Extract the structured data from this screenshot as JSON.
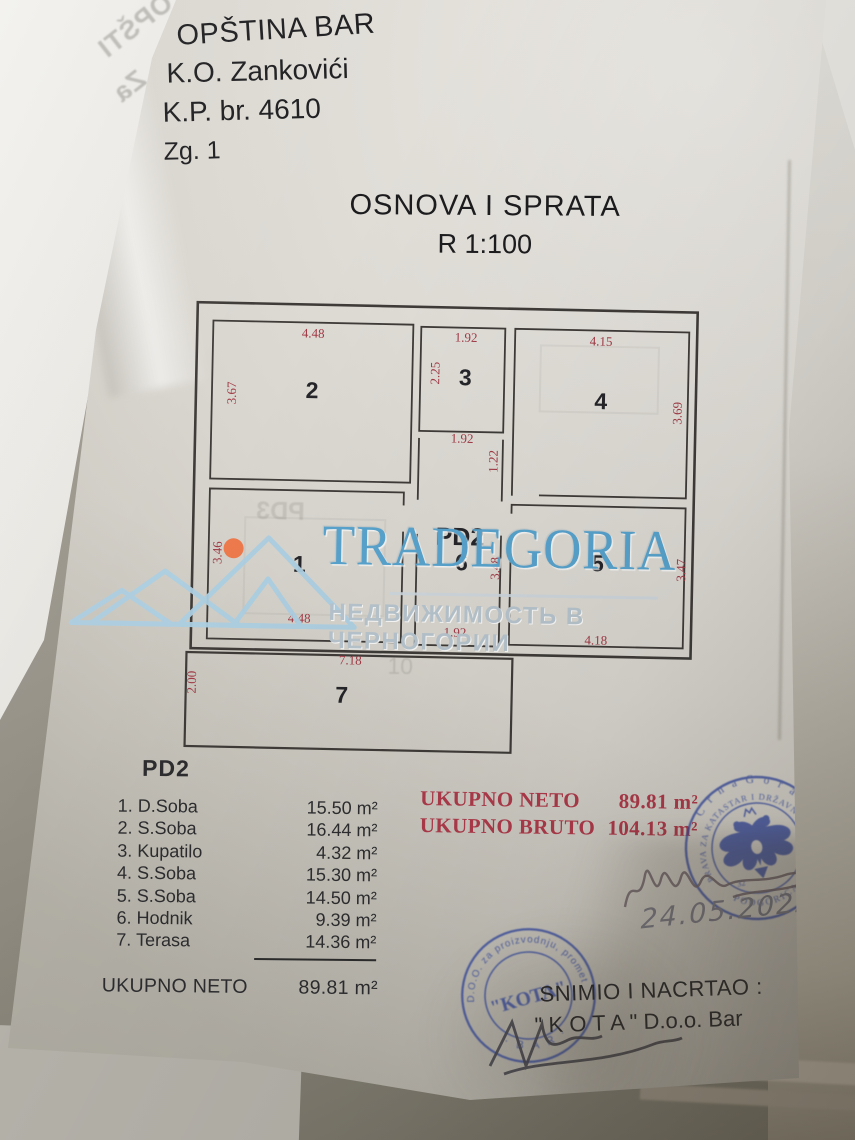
{
  "header": {
    "line1": "OPŠTINA BAR",
    "line2": "K.O. Zankovići",
    "line3": "K.P. br. 4610",
    "line4": "Zg. 1"
  },
  "title": {
    "line1": "OSNOVA I SPRATA",
    "line2": "R 1:100"
  },
  "watermark": {
    "brand": "TRADEGORIA",
    "subtitle": "НЕДВИЖИМОСТЬ В ЧЕРНОГОРИИ",
    "brand_color": "#58a3cd",
    "logo_color": "#accfe2",
    "dot_color": "#ed7a4c"
  },
  "plan": {
    "dim_color": "#a03a46",
    "rooms": {
      "r1": {
        "num": "1",
        "d_left": "3.46",
        "d_bottom": "4.48"
      },
      "r2": {
        "num": "2",
        "d_top": "4.48",
        "d_left": "3.67"
      },
      "r3": {
        "num": "3",
        "d_top": "1.92",
        "d_left": "2.25"
      },
      "r4": {
        "num": "4",
        "d_top": "4.15",
        "d_right": "3.69"
      },
      "r5": {
        "num": "5",
        "d_right": "3.47",
        "d_bottom": "4.18"
      },
      "r6": {
        "label": "PD2",
        "num": "6",
        "d_right": "3.48",
        "d_bottom": "1.92"
      },
      "r7": {
        "num": "7",
        "d_top": "7.18",
        "d_left": "2.00"
      },
      "corridor": {
        "d_top": "1.92",
        "d_right": "1.22"
      }
    },
    "ghost_label": "PD3",
    "ghost_number": "10"
  },
  "room_list": {
    "heading": "PD2",
    "rows": [
      {
        "label": "1. D.Soba",
        "area": "15.50 m²"
      },
      {
        "label": "2. S.Soba",
        "area": "16.44 m²"
      },
      {
        "label": "3. Kupatilo",
        "area": "4.32 m²"
      },
      {
        "label": "4. S.Soba",
        "area": "15.30 m²"
      },
      {
        "label": "5. S.Soba",
        "area": "14.50 m²"
      },
      {
        "label": "6. Hodnik",
        "area": "9.39 m²"
      },
      {
        "label": "7. Terasa",
        "area": "14.36 m²"
      }
    ],
    "total_label": "UKUPNO NETO",
    "total_value": "89.81 m²"
  },
  "totals": {
    "neto_label": "UKUPNO NETO",
    "neto_value": "89.81 m²",
    "bruto_label": "UKUPNO BRUTO",
    "bruto_value": "104.13 m²",
    "color": "#ad3a4a"
  },
  "author": {
    "line1": "SNIMIO I NACRTAO :",
    "line2": "\" K O T A \" D.o.o. Bar"
  },
  "handwriting": {
    "date": "24.05.2022."
  },
  "stamps": {
    "color": "#3a4ea1",
    "katastar": {
      "country": "C r n a   G o r a",
      "ring": "UPRAVA ZA KATASTAR I DRŽAVNU IMOVINU",
      "city": "PODGORICA",
      "number": "32"
    },
    "kota": {
      "ring_top": "D.O.O.  za  proizvodnju,  promet",
      "ring_bottom": "·  B A R  ·",
      "center": "\"KOTA\""
    }
  },
  "back_sheet": {
    "line1": "OPŠTI",
    "line2": "K.O. Za",
    "line3": "K.P. b",
    "line4": "Zg."
  }
}
